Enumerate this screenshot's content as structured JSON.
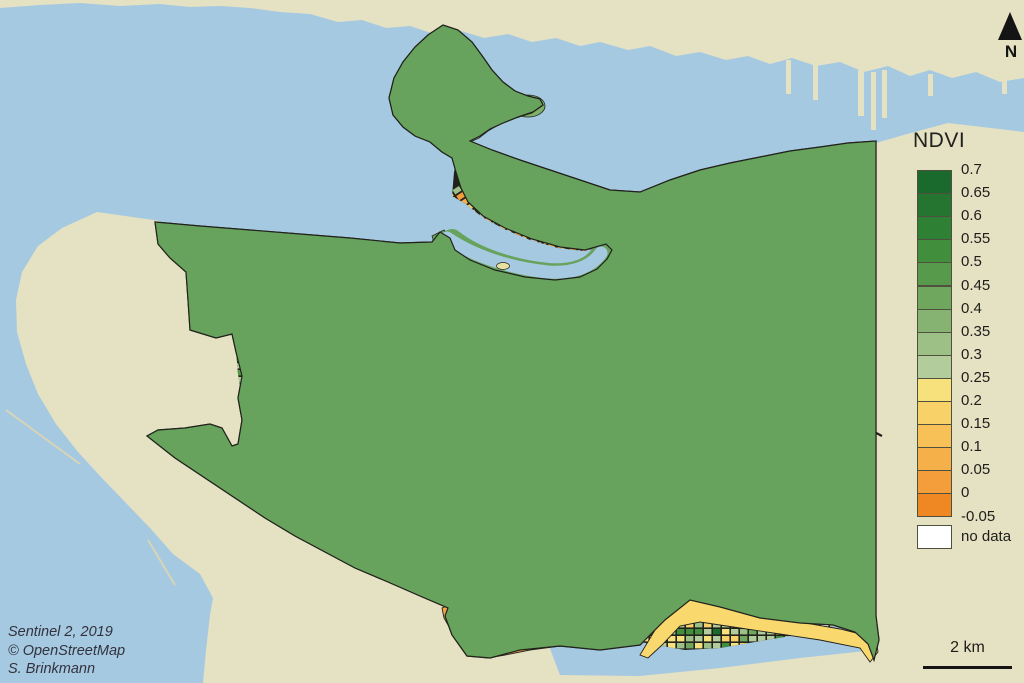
{
  "legend": {
    "title": "NDVI",
    "tick_labels": [
      "0.7",
      "0.65",
      "0.6",
      "0.55",
      "0.5",
      "0.45",
      "0.4",
      "0.35",
      "0.3",
      "0.25",
      "0.2",
      "0.15",
      "0.1",
      "0.05",
      "0",
      "-0.05"
    ],
    "ramp_colors": [
      "#1a692d",
      "#25742f",
      "#2e8134",
      "#418e3c",
      "#589a4c",
      "#6fa75f",
      "#86b372",
      "#9cc086",
      "#b2cd9b",
      "#f6e17c",
      "#f8d168",
      "#f8c158",
      "#f6b04a",
      "#f49e3b",
      "#ef8722"
    ],
    "no_data_label": "no data",
    "no_data_color": "#ffffff"
  },
  "north_arrow": {
    "label": "N"
  },
  "scale_bar": {
    "label": "2 km"
  },
  "attribution": {
    "line1": "Sentinel 2, 2019",
    "line2": "© OpenStreetMap",
    "line3": "S. Brinkmann"
  },
  "map_colors": {
    "water": "#a6c9e2",
    "land": "#e5e1c3",
    "street": "#22221c",
    "park_green": "#67a35c",
    "mid_park": "#4f9549",
    "stanley_light": "#b6d3aa",
    "shore_strip": "#aecfa0",
    "dark_park": "#2c7c35",
    "orange_strip": "#f5a14b",
    "yellow_strip": "#f9d96e",
    "jetty": "#d8d4b4",
    "island": "#e8e0a0",
    "downtown_gray": "#d9d6c6"
  }
}
